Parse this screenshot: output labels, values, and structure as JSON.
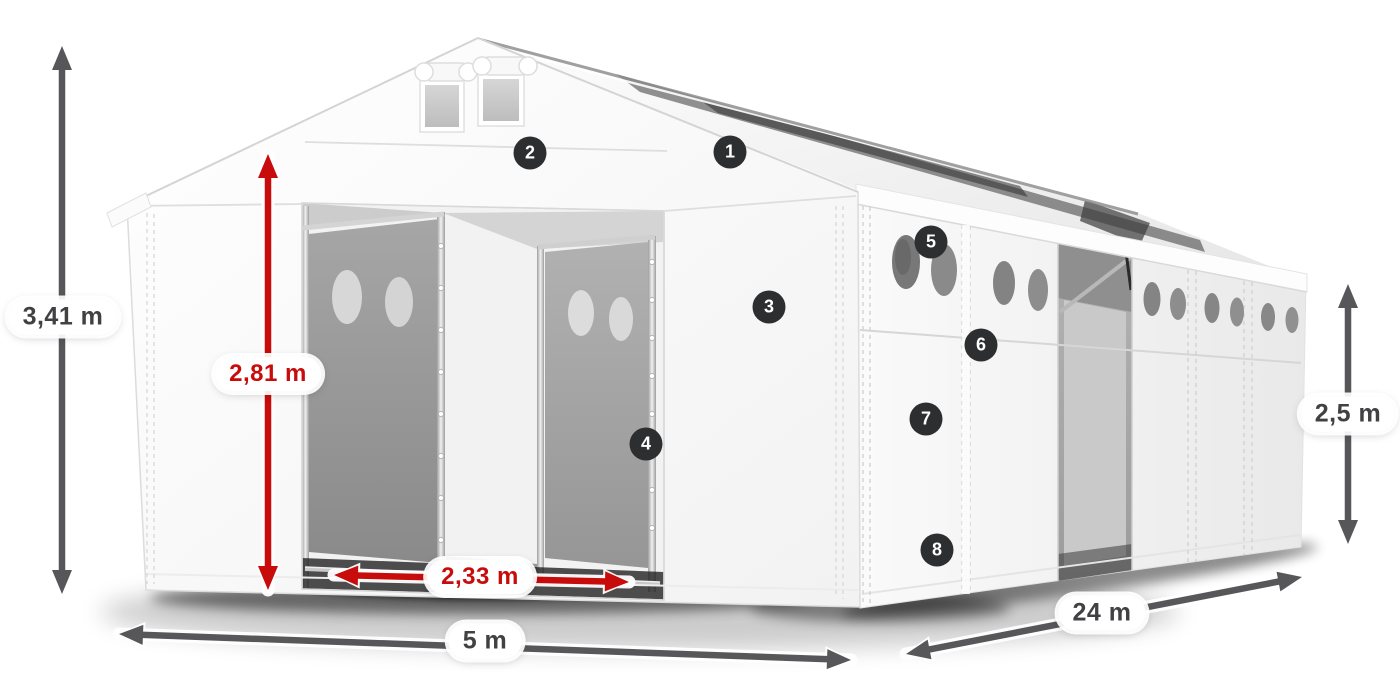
{
  "canvas": {
    "width": 1400,
    "height": 700,
    "background": "#ffffff"
  },
  "colors": {
    "arrow_gray": "#57575a",
    "arrow_red": "#c80b0b",
    "label_text_gray": "#414144",
    "label_text_red": "#c80b0b",
    "label_bg": "#ffffff",
    "marker_bg": "#2c2e2f",
    "marker_text": "#ffffff"
  },
  "annotations": {
    "dimensions": [
      {
        "id": "total-height",
        "label": "3,41 m",
        "style": "gray",
        "x1": 62,
        "y1": 46,
        "x2": 62,
        "y2": 594,
        "label_x": 63,
        "label_y": 317
      },
      {
        "id": "entrance-height",
        "label": "2,81 m",
        "style": "red",
        "x1": 268,
        "y1": 154,
        "x2": 268,
        "y2": 590,
        "label_x": 268,
        "label_y": 374
      },
      {
        "id": "entrance-width",
        "label": "2,33 m",
        "style": "red",
        "x1": 334,
        "y1": 575,
        "x2": 629,
        "y2": 582,
        "label_x": 480,
        "label_y": 577
      },
      {
        "id": "front-width",
        "label": "5 m",
        "style": "gray",
        "x1": 119,
        "y1": 634,
        "x2": 851,
        "y2": 660,
        "label_x": 485,
        "label_y": 641
      },
      {
        "id": "side-length",
        "label": "24 m",
        "style": "gray",
        "x1": 906,
        "y1": 654,
        "x2": 1302,
        "y2": 577,
        "label_x": 1102,
        "label_y": 613
      },
      {
        "id": "side-height",
        "label": "2,5 m",
        "style": "gray",
        "x1": 1348,
        "y1": 284,
        "x2": 1348,
        "y2": 544,
        "label_x": 1348,
        "label_y": 414
      }
    ],
    "markers": [
      {
        "number": "1",
        "x": 730,
        "y": 152
      },
      {
        "number": "2",
        "x": 530,
        "y": 153
      },
      {
        "number": "3",
        "x": 769,
        "y": 307
      },
      {
        "number": "4",
        "x": 646,
        "y": 444
      },
      {
        "number": "5",
        "x": 931,
        "y": 242
      },
      {
        "number": "6",
        "x": 981,
        "y": 345
      },
      {
        "number": "7",
        "x": 926,
        "y": 419
      },
      {
        "number": "8",
        "x": 937,
        "y": 550
      }
    ]
  }
}
